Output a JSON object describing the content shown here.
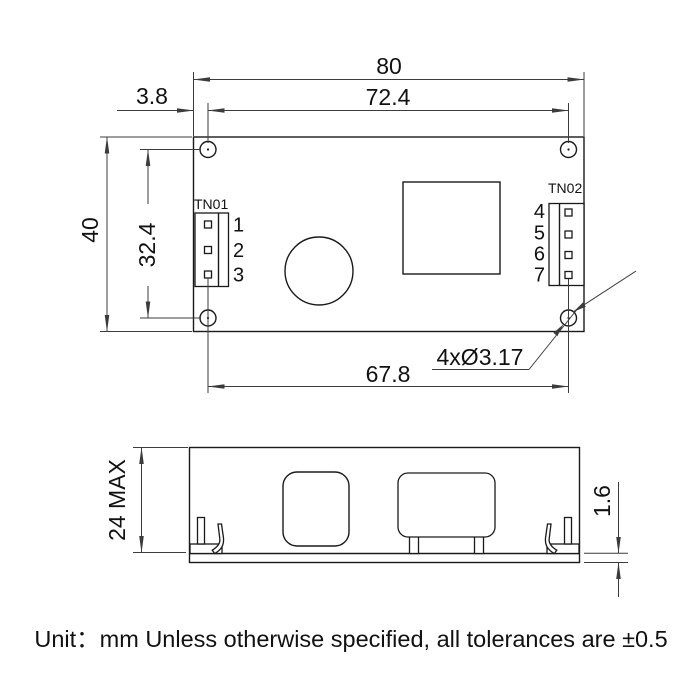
{
  "top_view": {
    "dim_overall_width": "80",
    "dim_hole_span_x": "72.4",
    "dim_hole_edge_offset": "3.8",
    "dim_overall_height": "40",
    "dim_hole_span_y": "32.4",
    "dim_bottom_hole_span": "67.8",
    "dim_hole_callout": "4xØ3.17",
    "connector_left": {
      "label": "TN01",
      "pins": [
        "1",
        "2",
        "3"
      ]
    },
    "connector_right": {
      "label": "TN02",
      "pins": [
        "4",
        "5",
        "6",
        "7"
      ]
    }
  },
  "side_view": {
    "dim_height": "24 MAX",
    "dim_pcb_thickness": "1.6"
  },
  "note": "Unit：mm Unless otherwise specified, all tolerances are ±0.5",
  "colors": {
    "line": "#1a1a1a",
    "dimension": "#3c3c3c",
    "background": "#ffffff"
  }
}
